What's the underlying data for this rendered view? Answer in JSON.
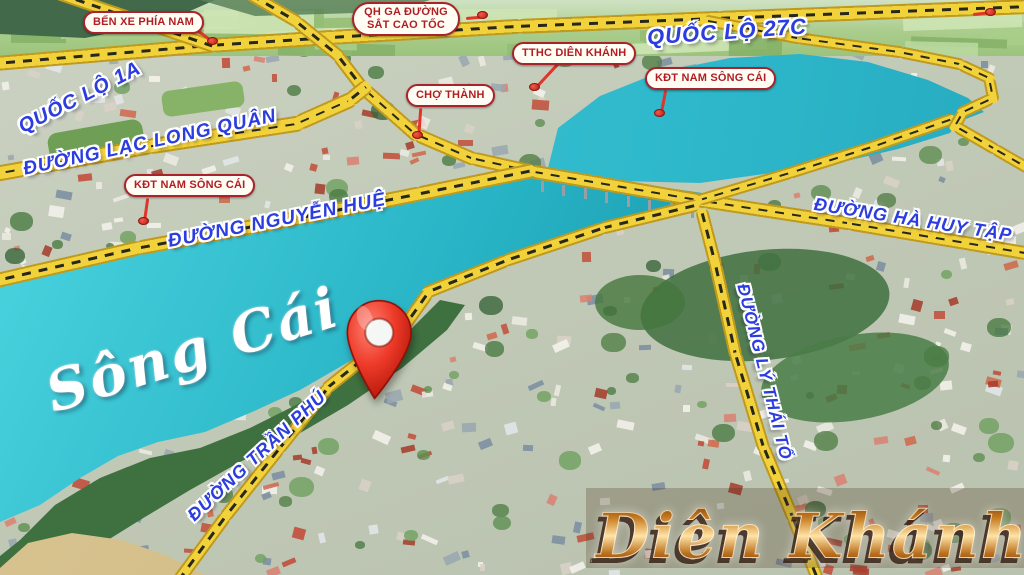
{
  "labels": {
    "pills": [
      {
        "id": "ben-xe-phia-nam",
        "label": "BẾN XE PHÍA NAM"
      },
      {
        "id": "qh-ga-duong-sat-cao-toc",
        "label": "QH GA ĐƯỜNG SẮT CAO TỐC"
      },
      {
        "id": "tthc-dien-khanh",
        "label": "TTHC DIÊN KHÁNH"
      },
      {
        "id": "kdt-nam-song-cai-east",
        "label": "KĐT NAM SÔNG CÁI"
      },
      {
        "id": "cho-thanh",
        "label": "CHỢ THÀNH"
      },
      {
        "id": "kdt-nam-song-cai-west",
        "label": "KĐT NAM SÔNG CÁI"
      }
    ],
    "roads": [
      {
        "id": "quoc-lo-1a",
        "label": "QUỐC LỘ 1A"
      },
      {
        "id": "duong-lac-long-quan",
        "label": "ĐƯỜNG LẠC LONG QUÂN"
      },
      {
        "id": "quoc-lo-27c",
        "label": "QUỐC LỘ 27C"
      },
      {
        "id": "duong-nguyen-hue",
        "label": "ĐƯỜNG NGUYỄN HUỆ"
      },
      {
        "id": "duong-ha-huy-tap",
        "label": "ĐƯỜNG HÀ HUY TẬP"
      },
      {
        "id": "duong-tran-phu",
        "label": "ĐƯỜNG TRẦN PHÚ"
      },
      {
        "id": "duong-ly-thai-to",
        "label": "ĐƯỜNG LÝ THÁI TỔ"
      }
    ],
    "watermarks": {
      "river": "Sông Cái",
      "city": "Diên Khánh"
    }
  },
  "colors": {
    "road_fill": "#f2d23a",
    "road_edge": "#bf9a1f",
    "river": "#2ab5c8",
    "label_blue": "#2b3ce0",
    "pill_red": "#b01e24",
    "pin_red": "#e03524",
    "city_gold": "#c87f24"
  }
}
